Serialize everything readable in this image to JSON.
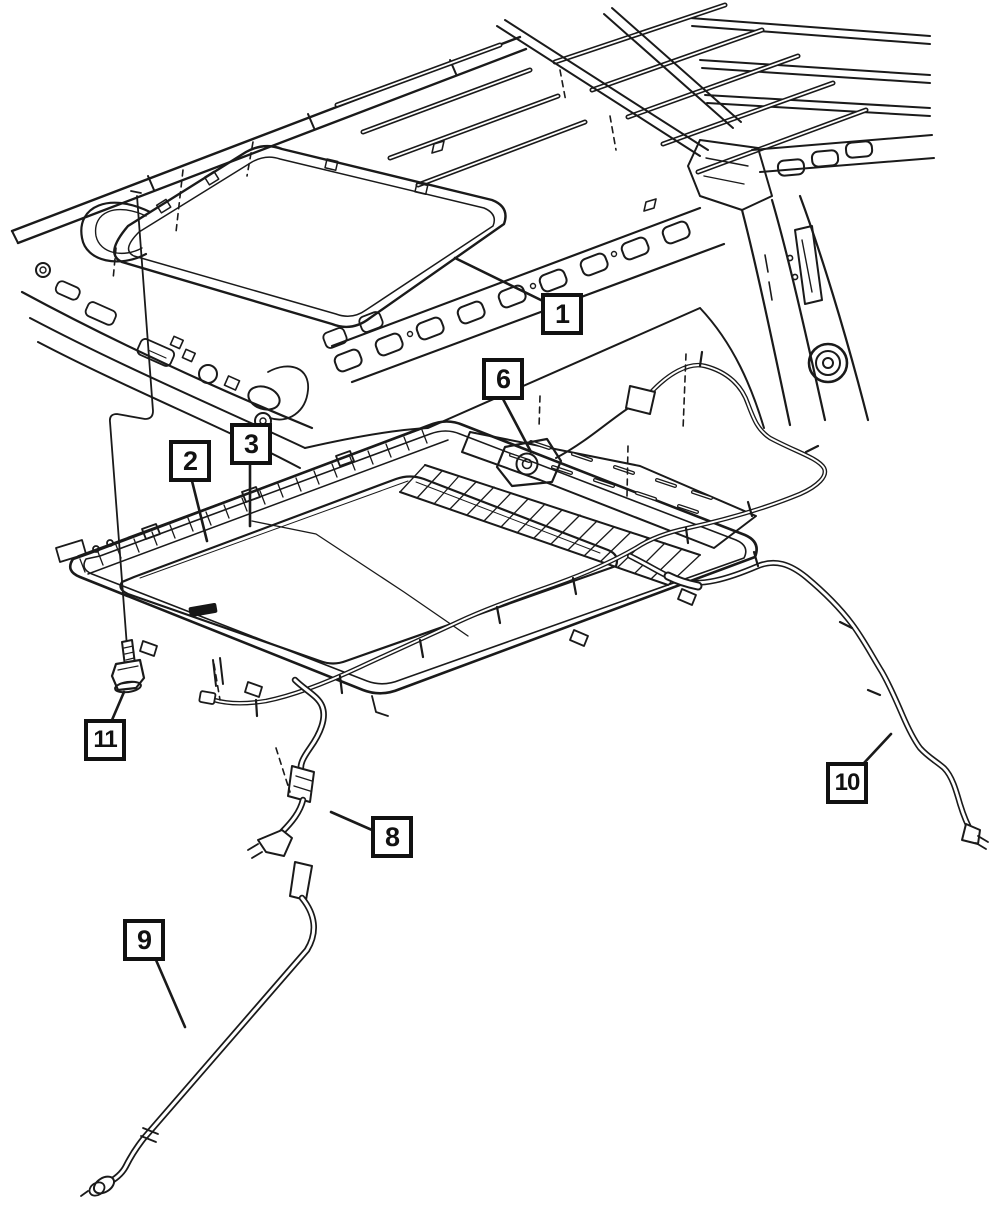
{
  "figure": {
    "background_color": "#ffffff",
    "line_color": "#1a1a1a",
    "callouts": [
      {
        "label": "1",
        "target": "roof-panel"
      },
      {
        "label": "2",
        "target": "sunroof-frame"
      },
      {
        "label": "3",
        "target": "sunroof-glass"
      },
      {
        "label": "6",
        "target": "sunroof-motor"
      },
      {
        "label": "8",
        "target": "front-drain-tube-upper"
      },
      {
        "label": "9",
        "target": "front-drain-tube-lower"
      },
      {
        "label": "10",
        "target": "rear-drain-tube"
      },
      {
        "label": "11",
        "target": "mounting-bolt"
      }
    ]
  }
}
